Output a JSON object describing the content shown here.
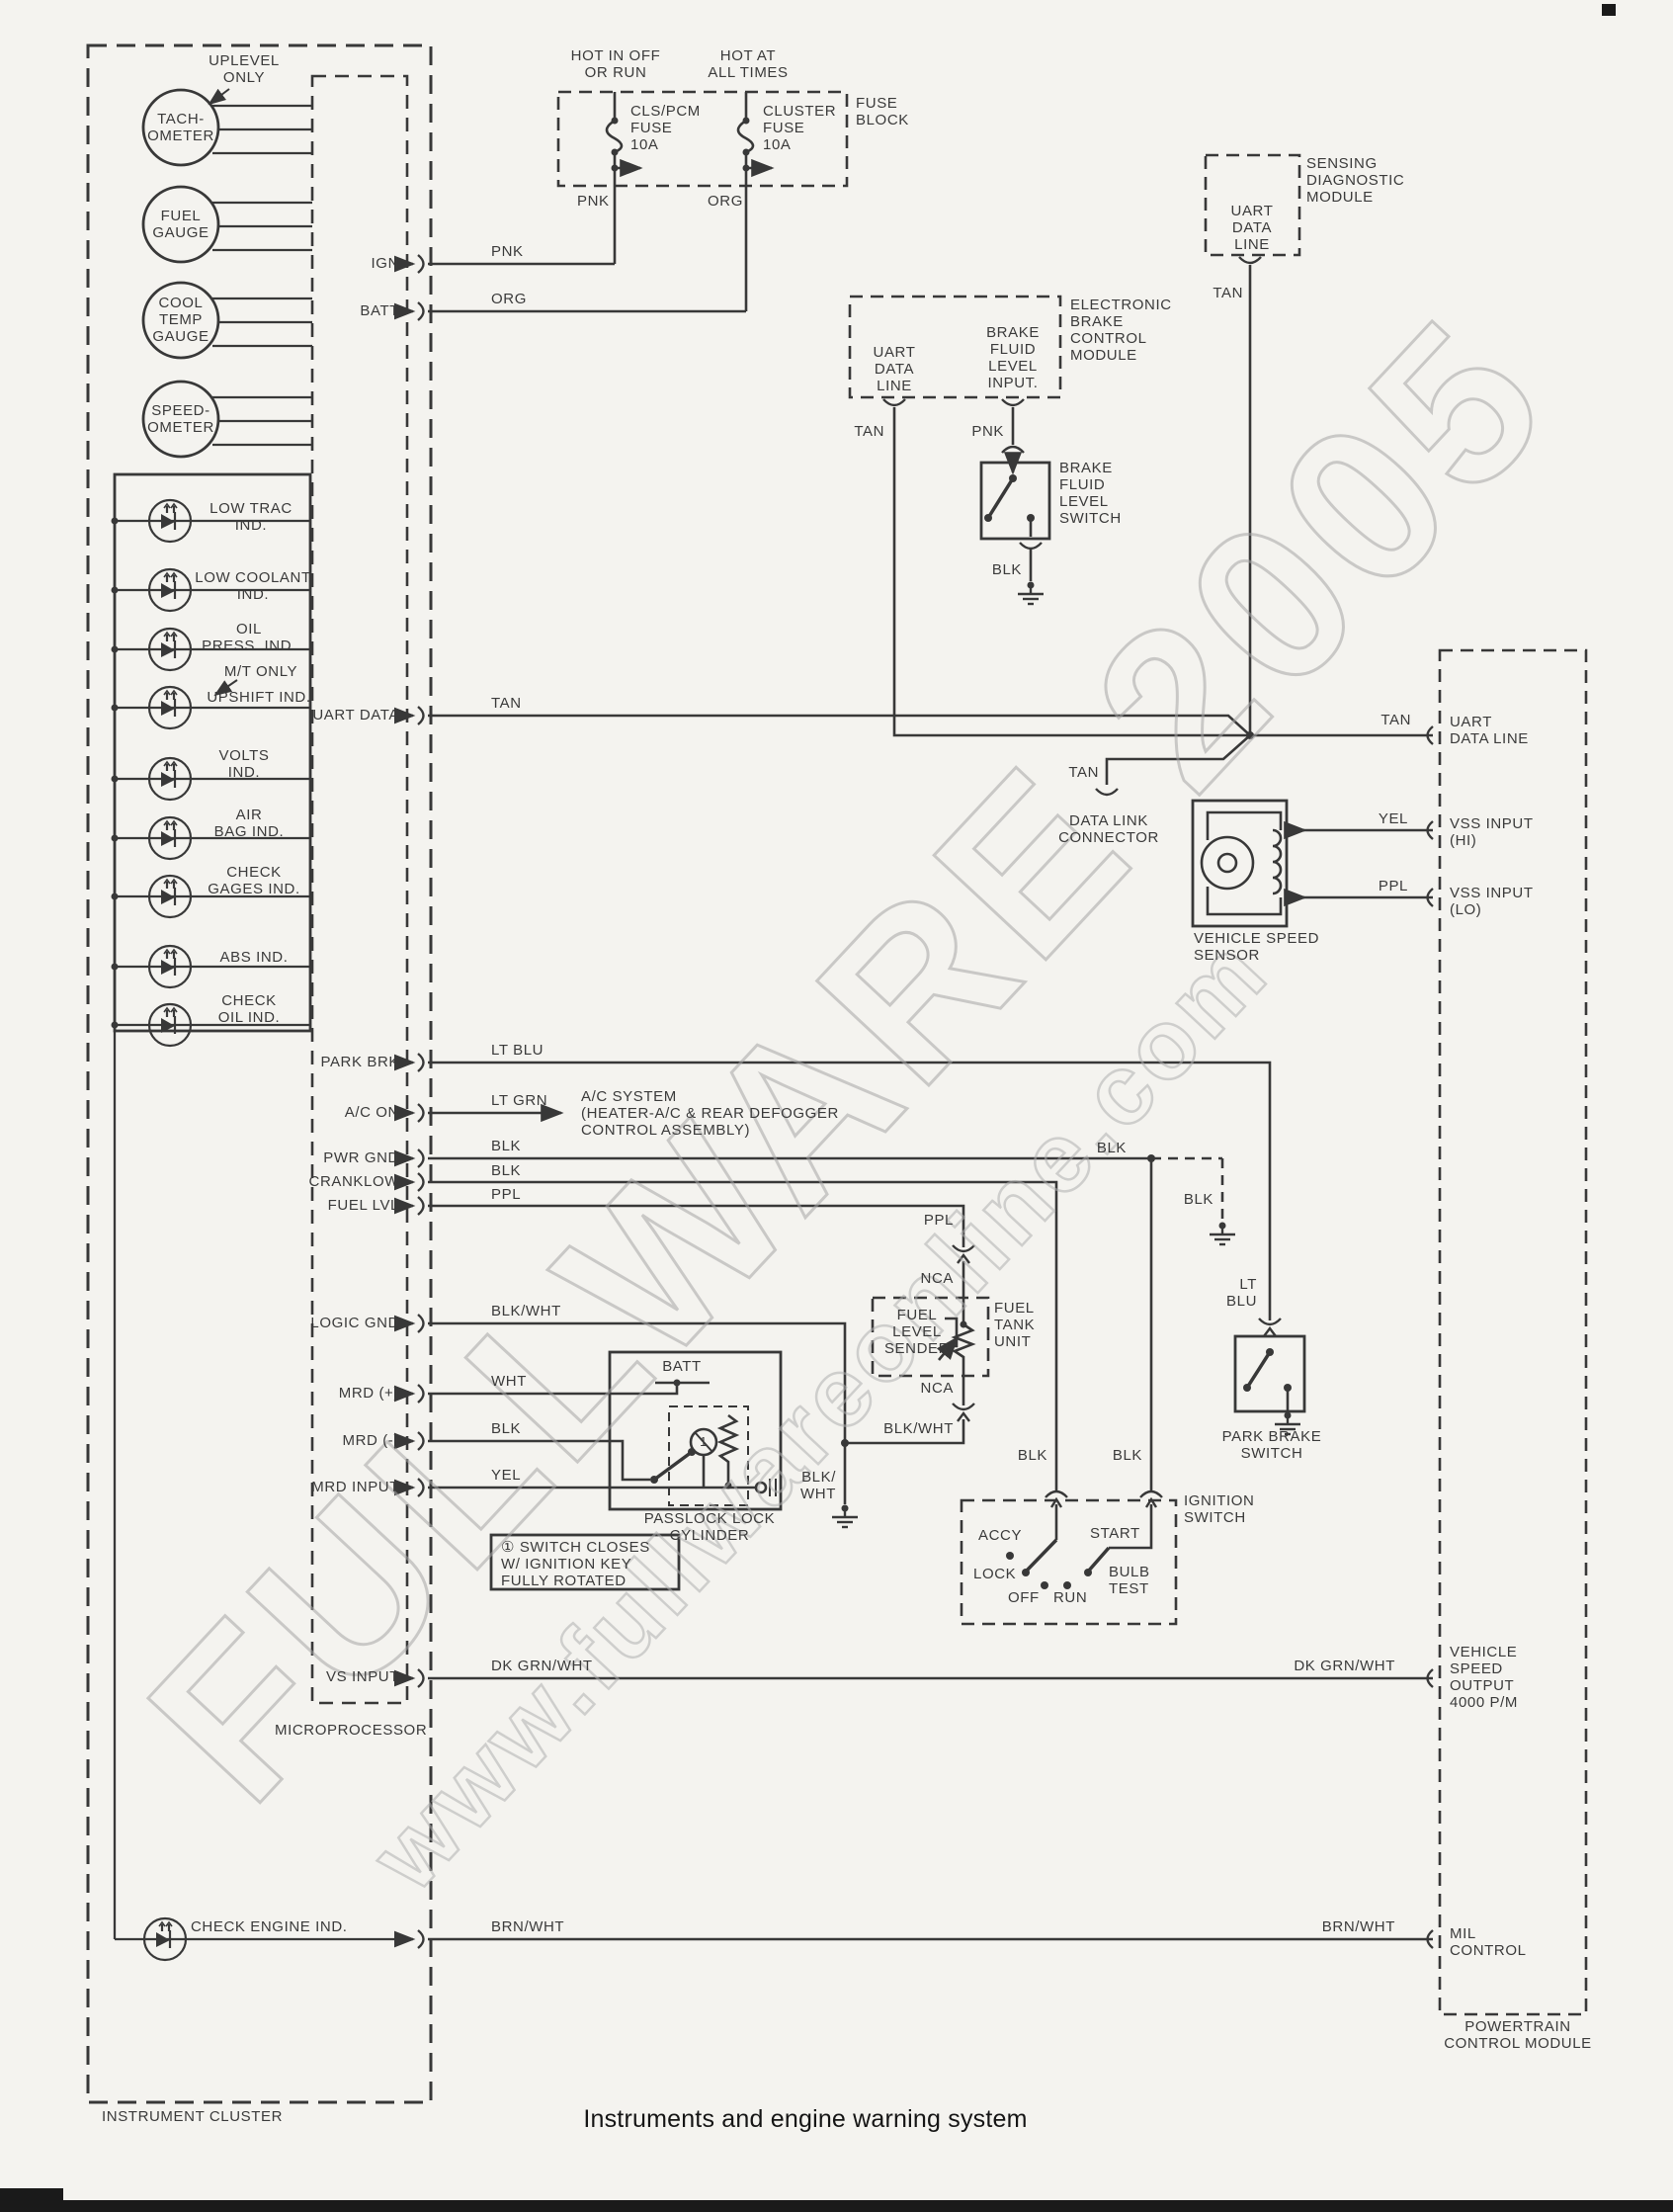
{
  "title": "Instruments and engine warning system",
  "colors": {
    "line": "#383838",
    "paper": "#f4f3ef",
    "watermark": "#a6a6a6"
  },
  "labels": {
    "caption": "Instruments and engine warning system",
    "wm1": "FULLWARE 2005",
    "wm2": "www.fullwareonline.com",
    "cluster_label": "INSTRUMENT CLUSTER",
    "micro_label": "MICROPROCESSOR",
    "uplevel": "UPLEVEL\nONLY",
    "gauge_tach": "TACH-\nOMETER",
    "gauge_fuel": "FUEL\nGAUGE",
    "gauge_cool": "COOL\nTEMP\nGAUGE",
    "gauge_speed": "SPEED-\nOMETER",
    "ind_lowtrac": "LOW TRAC\nIND.",
    "ind_lowcool": "LOW COOLANT\nIND.",
    "ind_oil": "OIL\nPRESS. IND.",
    "mt_only": "M/T ONLY",
    "ind_upshift": "UPSHIFT IND.",
    "ind_volts": "VOLTS\nIND.",
    "ind_airbag": "AIR\nBAG IND.",
    "ind_gages": "CHECK\nGAGES IND.",
    "ind_abs": "ABS IND.",
    "ind_checkoil": "CHECK\nOIL IND.",
    "ind_checkeng": "CHECK ENGINE IND.",
    "pin_ign": "IGN",
    "pin_batt": "BATT",
    "pin_uart": "UART DATA",
    "pin_parkbrk": "PARK BRK",
    "pin_acon": "A/C ON",
    "pin_pwrgnd": "PWR GND",
    "pin_cranklow": "CRANKLOW",
    "pin_fuellvl": "FUEL LVL",
    "pin_logicgnd": "LOGIC GND",
    "pin_mrdp": "MRD (+)",
    "pin_mrdm": "MRD (-)",
    "pin_mrdin": "MRD INPUT",
    "pin_vsinput": "VS INPUT",
    "fuse_hot1": "HOT IN OFF\nOR RUN",
    "fuse_hot2": "HOT AT\nALL TIMES",
    "fuse_block": "FUSE\nBLOCK",
    "fuse1": "CLS/PCM\nFUSE\n10A",
    "fuse2": "CLUSTER\nFUSE\n10A",
    "w_pnk1": "PNK",
    "w_org1": "ORG",
    "w_pnk_fuse": "PNK",
    "w_org_fuse": "ORG",
    "w_tan_uart": "TAN",
    "w_tan_sdm": "TAN",
    "w_tan_ebcm": "TAN",
    "w_pnk_ebcm": "PNK",
    "w_blk_bfl": "BLK",
    "w_tan_right": "TAN",
    "w_tan_dlc": "TAN",
    "w_yel_vss": "YEL",
    "w_ppl_vss": "PPL",
    "w_ltblu": "LT BLU",
    "w_ltgrn": "LT GRN",
    "w_blk_pwr": "BLK",
    "w_blk_crank": "BLK",
    "w_ppl_fuel": "PPL",
    "w_blkwht_logic": "BLK/WHT",
    "w_wht": "WHT",
    "w_blk_mrd": "BLK",
    "w_yel_mrd": "YEL",
    "w_dkgrn_l": "DK GRN/WHT",
    "w_dkgrn_r": "DK GRN/WHT",
    "w_brnwht_l": "BRN/WHT",
    "w_brnwht_r": "BRN/WHT",
    "w_blk_junction": "BLK",
    "w_blk_gnd_dash": "BLK",
    "w_ltblu2": "LT\nBLU",
    "w_ppl2": "PPL",
    "w_nca1": "NCA",
    "w_nca2": "NCA",
    "w_blkwht2": "BLK/WHT",
    "w_blkwht3": "BLK/\nWHT",
    "w_blk_ign1": "BLK",
    "w_blk_ign2": "BLK",
    "batt_label": "BATT",
    "sdm_pin": "UART\nDATA\nLINE",
    "sdm_label": "SENSING\nDIAGNOSTIC\nMODULE",
    "ebcm_pin1": "UART\nDATA\nLINE",
    "ebcm_pin2": "BRAKE\nFLUID\nLEVEL\nINPUT.",
    "ebcm_label": "ELECTRONIC\nBRAKE\nCONTROL\nMODULE",
    "bfl_label": "BRAKE\nFLUID\nLEVEL\nSWITCH",
    "dlc_label": "DATA LINK\nCONNECTOR",
    "vss_label": "VEHICLE SPEED\nSENSOR",
    "ac_label": "A/C SYSTEM\n(HEATER-A/C & REAR DEFOGGER\nCONTROL ASSEMBLY)",
    "ftu_pin": "FUEL\nLEVEL\nSENDER",
    "ftu_label": "FUEL\nTANK\nUNIT",
    "pbs_label": "PARK BRAKE\nSWITCH",
    "ign_label": "IGNITION\nSWITCH",
    "ign_accy": "ACCY",
    "ign_lock": "LOCK",
    "ign_off": "OFF",
    "ign_run": "RUN",
    "ign_start": "START",
    "ign_bulb": "BULB\nTEST",
    "passlock_label": "PASSLOCK LOCK\nCYLINDER",
    "passlock_key_num": "1",
    "note_text": "① SWITCH CLOSES\nW/ IGNITION KEY\nFULLY ROTATED",
    "pcm_uart": "UART\nDATA LINE",
    "pcm_vss_hi": "VSS INPUT\n(HI)",
    "pcm_vss_lo": "VSS INPUT\n(LO)",
    "pcm_vso": "VEHICLE\nSPEED\nOUTPUT\n4000 P/M",
    "pcm_mil": "MIL\nCONTROL",
    "pcm_label": "POWERTRAIN\nCONTROL MODULE"
  }
}
